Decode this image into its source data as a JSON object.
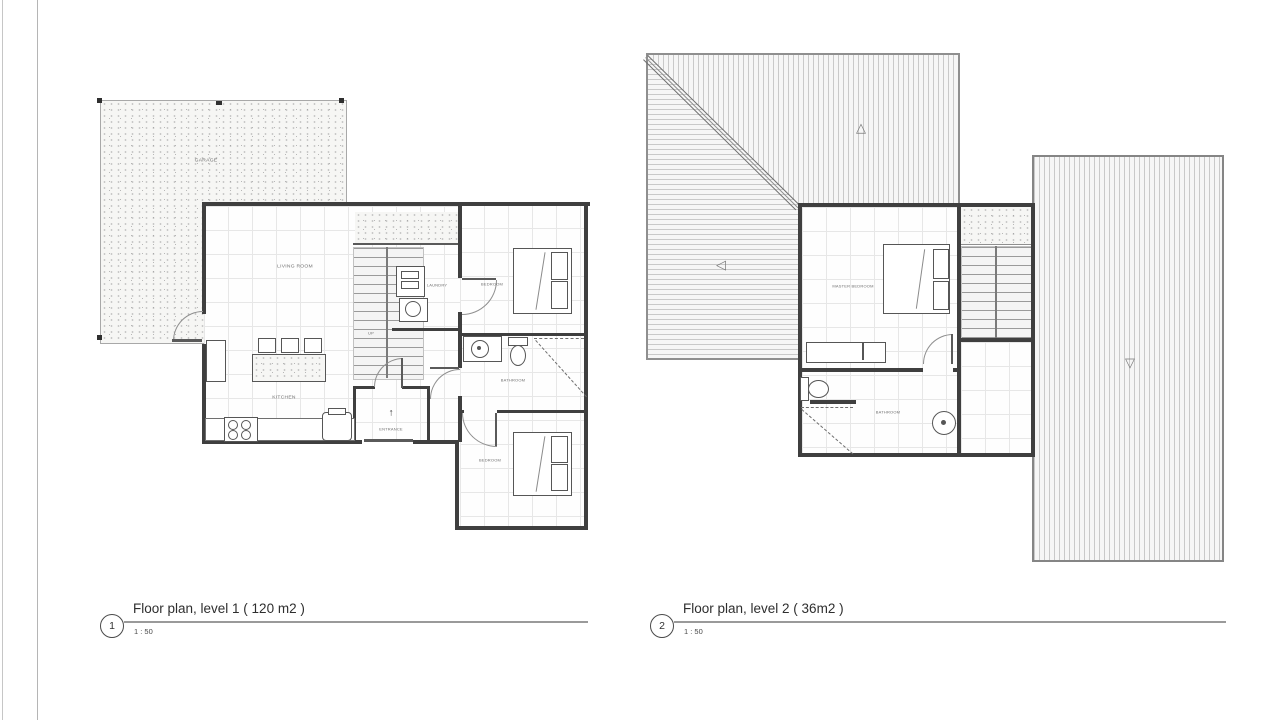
{
  "sheet": {
    "background": "#ffffff",
    "page_edge_color": "#bfbfbf",
    "wall_color": "#3f3f3f",
    "grid_color": "#e7e7e7",
    "label_color": "#6f6f6f"
  },
  "plans": [
    {
      "number": "1",
      "title": "Floor plan, level 1 ( 120 m2 )",
      "scale": "1 : 50",
      "rooms": {
        "garage": "GARAGE",
        "living": "LIVING ROOM",
        "kitchen": "KITCHEN",
        "laundry": "LAUNDRY",
        "entrance": "ENTRANCE",
        "bedroom_top": "BEDROOM",
        "bathroom": "BATHROOM",
        "bedroom_bottom": "BEDROOM",
        "stairs": "UP"
      }
    },
    {
      "number": "2",
      "title": "Floor plan, level 2 ( 36m2 )",
      "scale": "1 : 50",
      "rooms": {
        "master": "MASTER BEDROOM",
        "bathroom": "BATHROOM"
      },
      "roof_markers": {
        "up": "△",
        "left": "◁",
        "down": "▽"
      }
    }
  ],
  "icons": {
    "entry_arrow": "↑"
  }
}
